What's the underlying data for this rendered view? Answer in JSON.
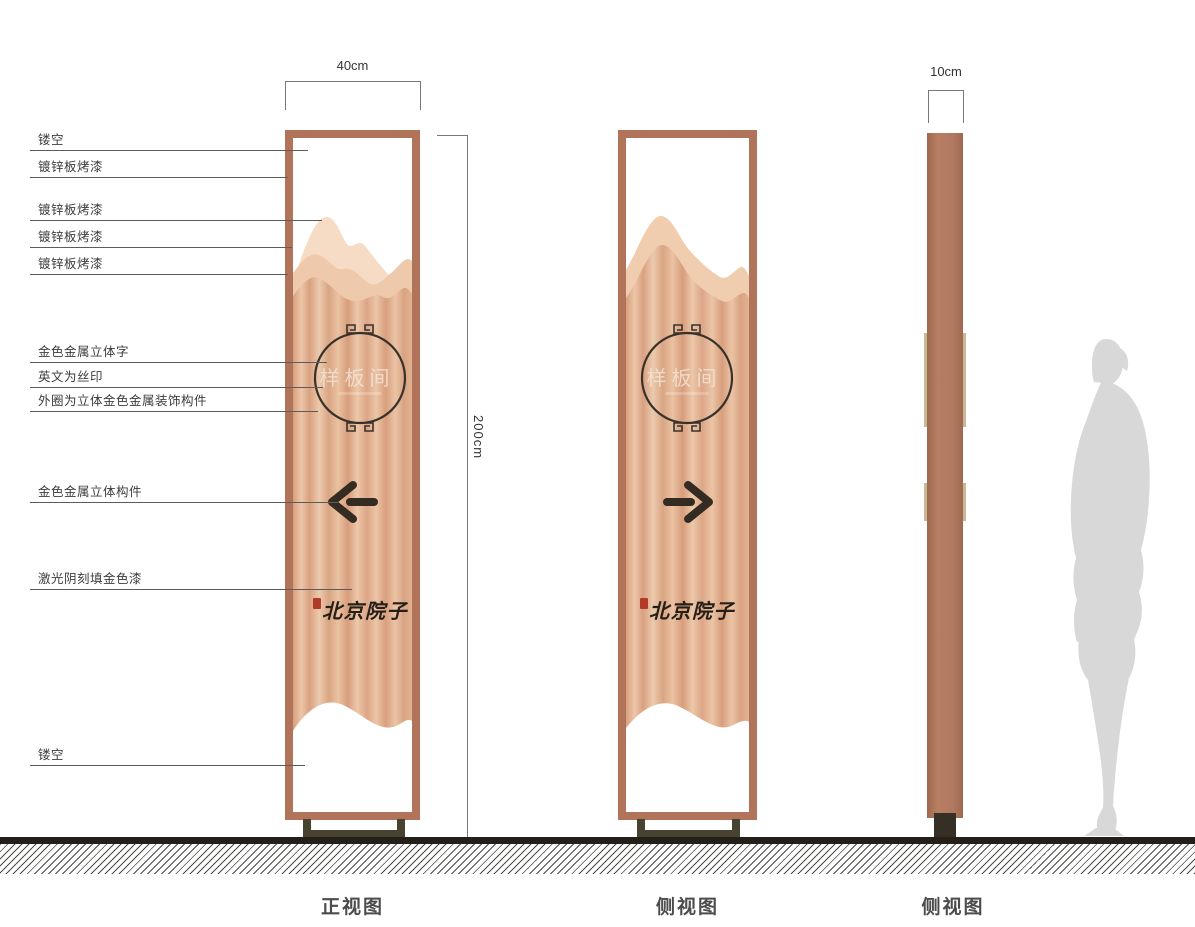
{
  "dimensions": {
    "front_width": "40cm",
    "height": "200cm",
    "side_depth": "10cm"
  },
  "labels": [
    {
      "text": "镂空"
    },
    {
      "text": "镀锌板烤漆"
    },
    {
      "text": "镀锌板烤漆"
    },
    {
      "text": "镀锌板烤漆"
    },
    {
      "text": "镀锌板烤漆"
    },
    {
      "text": "金色金属立体字"
    },
    {
      "text": "英文为丝印"
    },
    {
      "text": "外圈为立体金色金属装饰构件"
    },
    {
      "text": "金色金属立体构件"
    },
    {
      "text": "激光阴刻填金色漆"
    },
    {
      "text": "镂空"
    }
  ],
  "sign": {
    "circle_text": "样板间",
    "brand_text": "北京院子"
  },
  "views": [
    {
      "label": "正视图"
    },
    {
      "label": "侧视图"
    },
    {
      "label": "侧视图"
    }
  ],
  "icons": {
    "front_arrow": "left-arrow",
    "side_arrow": "right-arrow",
    "circle_ornament": "fret-ornament",
    "stamp": "red-seal"
  },
  "colors": {
    "frame": "#b1735a",
    "body_light": "#ecc6a8",
    "body_dark": "#d89f7e",
    "mountain_light": "#f6dcc4",
    "mountain_mid": "#eec9ab",
    "pedestal": "#474330",
    "seal_red": "#b23a28",
    "ink": "#39322b",
    "silhouette": "#d8d8d8"
  }
}
